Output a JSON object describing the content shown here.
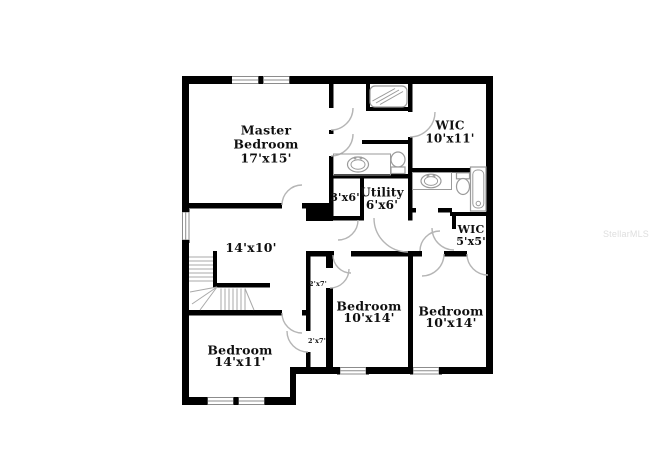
{
  "watermark": "StellarMLS",
  "rooms": {
    "master": {
      "name_line1": "Master",
      "name_line2": "Bedroom",
      "dims": "17'x15'"
    },
    "wic_top": {
      "name": "WIC",
      "dims": "10'x11'"
    },
    "closet_3x6": {
      "dims": "3'x6'"
    },
    "utility": {
      "name": "Utility",
      "dims": "6'x6'"
    },
    "wic_small": {
      "name": "WIC",
      "dims": "5'x5'"
    },
    "landing": {
      "dims": "14'x10'"
    },
    "closet_upper": {
      "dims": "2'x7'"
    },
    "closet_lower": {
      "dims": "2'x7'"
    },
    "bedroom_middle": {
      "name": "Bedroom",
      "dims": "10'x14'"
    },
    "bedroom_right": {
      "name": "Bedroom",
      "dims": "10'x14'"
    },
    "bedroom_left": {
      "name": "Bedroom",
      "dims": "14'x11'"
    }
  },
  "colors": {
    "wall": "#000000",
    "background": "#ffffff",
    "watermark": "#dedede"
  }
}
